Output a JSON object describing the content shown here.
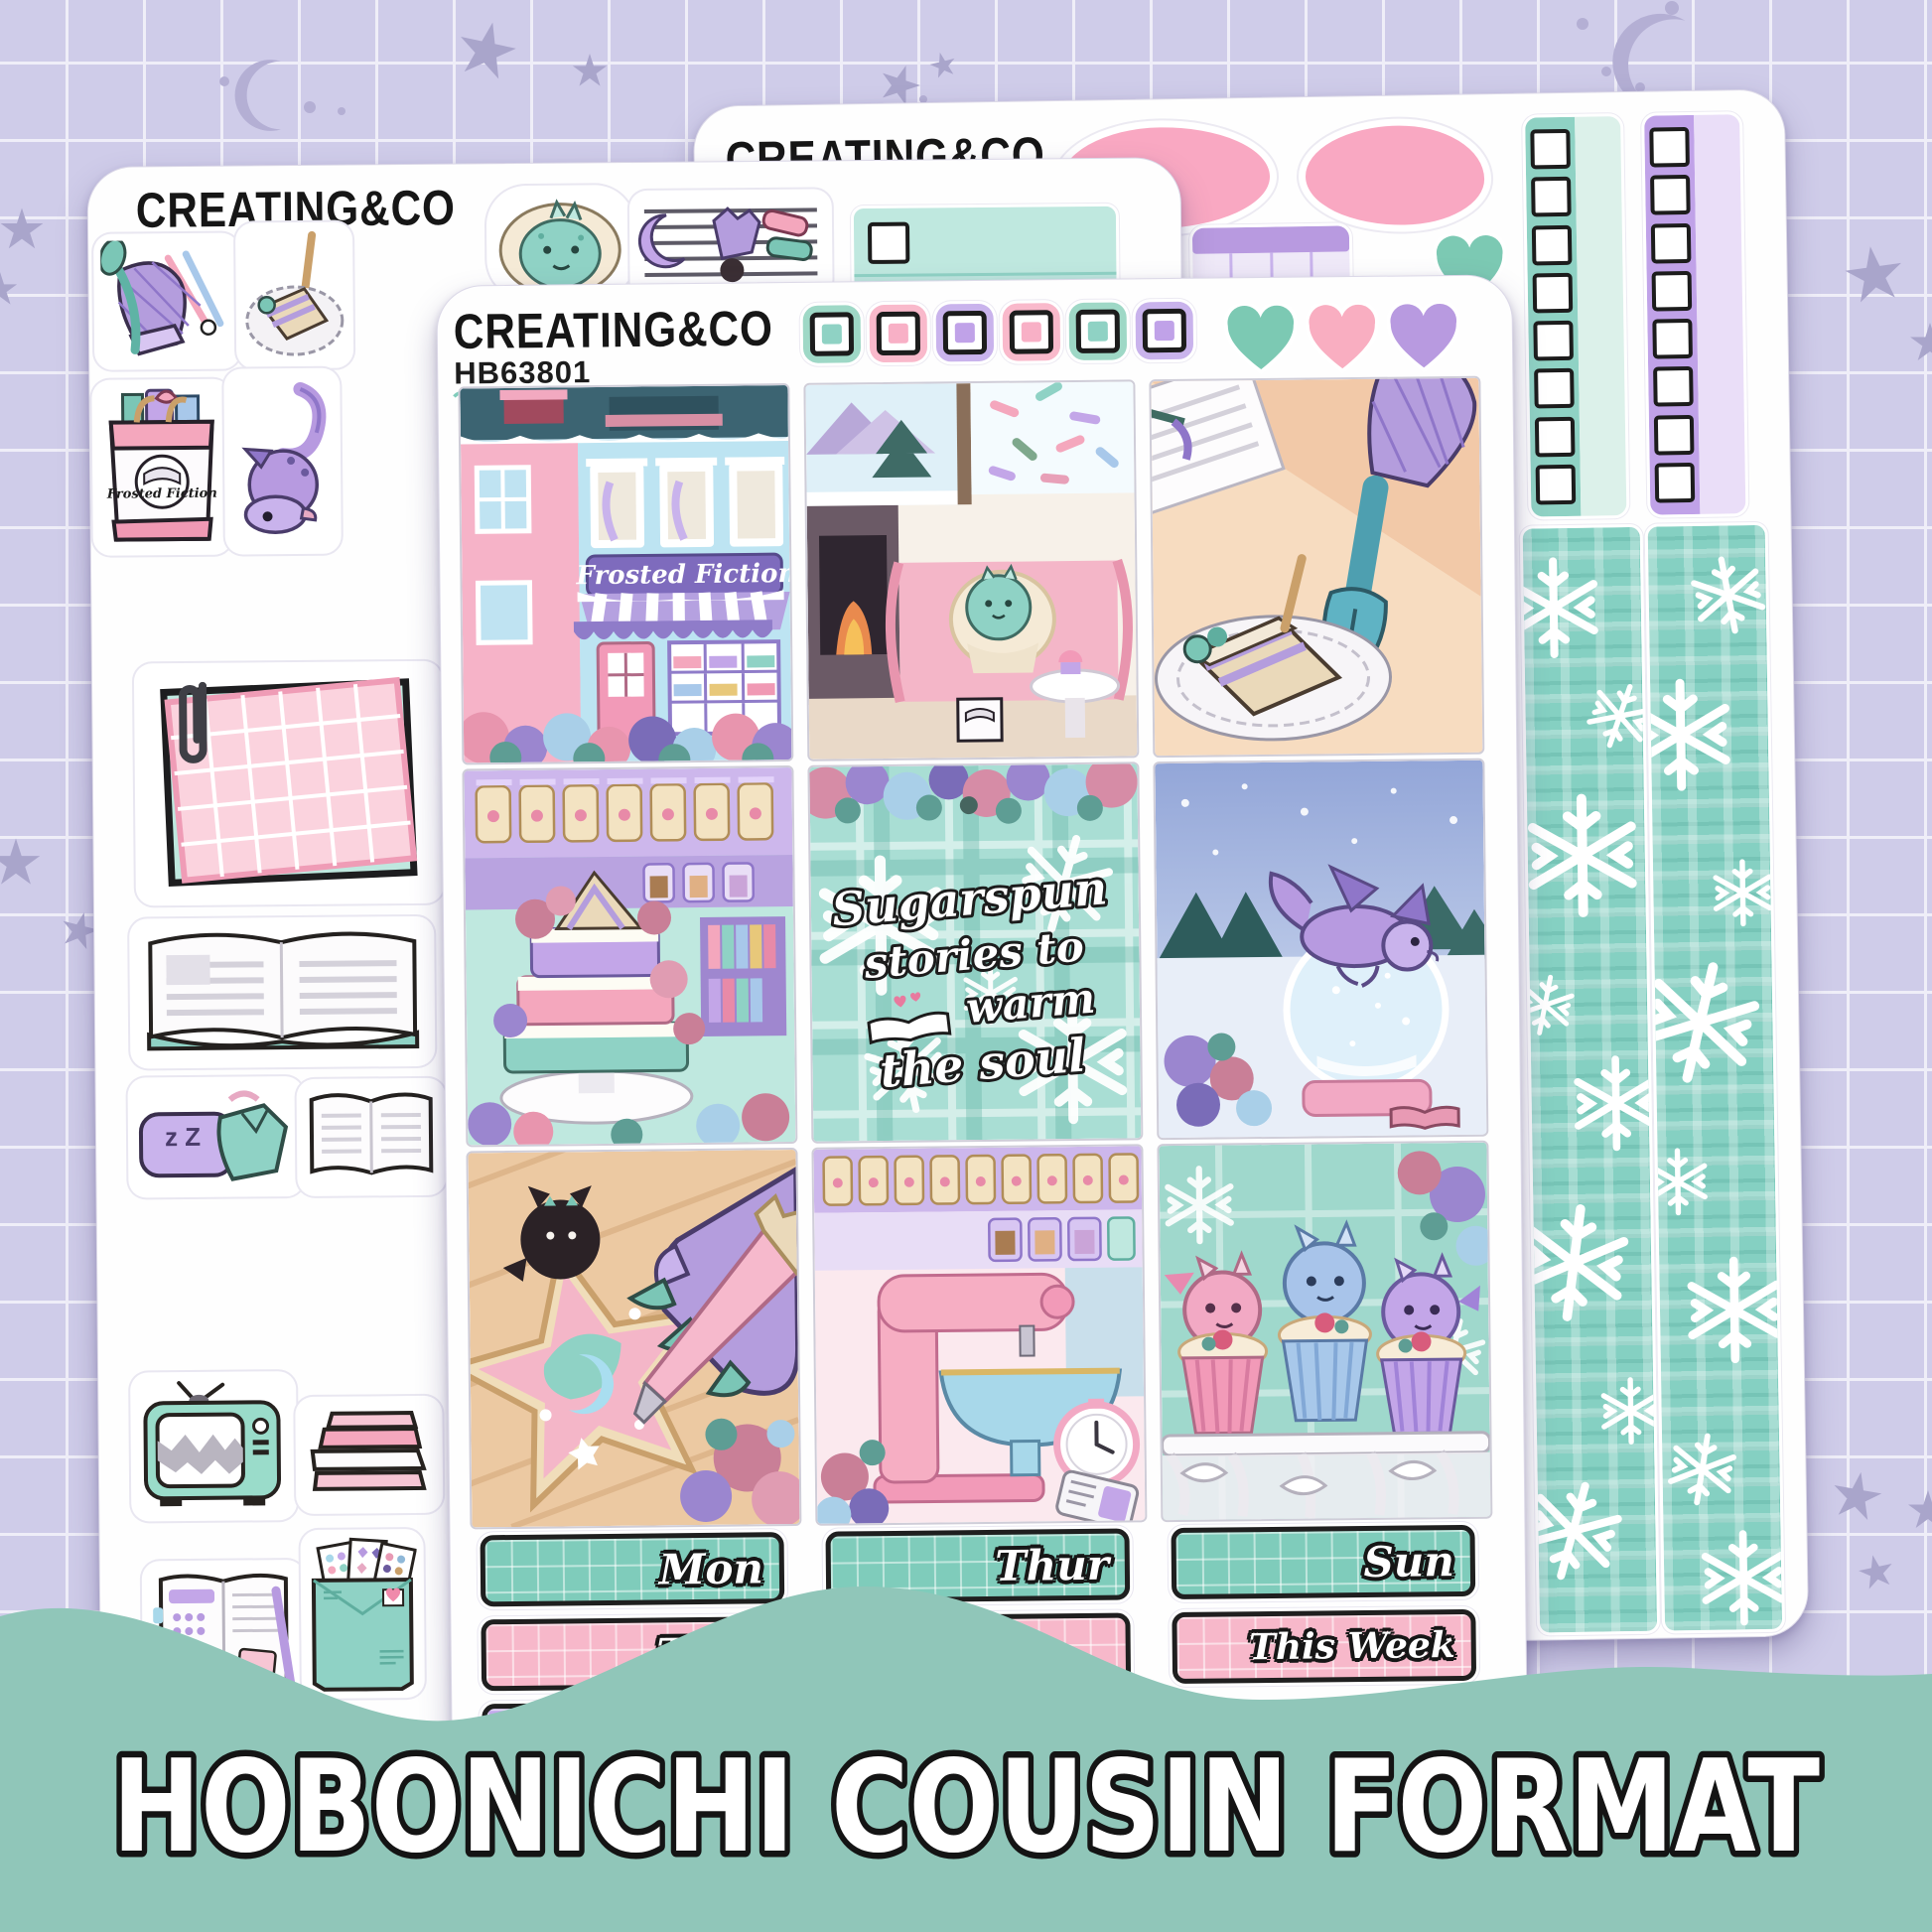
{
  "banner": {
    "text": "HOBONICHI COUSIN FORMAT",
    "color": "#90c6b9"
  },
  "brand": "CREATING&CO",
  "sheets": {
    "front": {
      "code": "HB63801"
    },
    "middle": {
      "code": "HB63802"
    },
    "back": {
      "note": "header and code mostly hidden behind other sheets"
    }
  },
  "header_stickers": {
    "checkbox_colors": [
      "teal",
      "pink",
      "purple",
      "pink",
      "teal",
      "purple"
    ],
    "heart_colors": [
      "teal",
      "pink",
      "purple"
    ]
  },
  "full_boxes": [
    "frosted-fiction-storefront",
    "dragon-reading-by-fireplace",
    "cake-slice-and-oven-mitt",
    "cake-of-books",
    "sugarspun-quote",
    "dragon-on-snow-globe",
    "cookie-decorating-claw",
    "pink-stand-mixer",
    "dragon-cupcakes"
  ],
  "storefront": {
    "sign": "Frosted Fiction"
  },
  "book_bag": {
    "label": "Frosted Fiction"
  },
  "quote_box": {
    "line1": "Sugarspun",
    "line2": "stories to",
    "line3": "warm",
    "line4": "the soul"
  },
  "pillow": {
    "text": "z Z"
  },
  "date_strips": {
    "col1": [
      {
        "label": "Mon",
        "color": "teal"
      },
      {
        "label": "Tues",
        "color": "pink"
      },
      {
        "label": "",
        "color": "purple"
      }
    ],
    "col2": [
      {
        "label": "Thur",
        "color": "teal"
      },
      {
        "label": "",
        "color": "pink"
      }
    ],
    "col3": [
      {
        "label": "Sun",
        "color": "teal"
      },
      {
        "label": "This Week",
        "color": "pink"
      }
    ]
  },
  "middle_sheet_stickers": [
    "oven-mitts-utensils",
    "cake-plate",
    "dragon-in-blanket",
    "cooling-rack-cookies",
    "book-tote-bag",
    "purple-dragon",
    "paperclip-grid-note",
    "open-book",
    "pillow-pajamas",
    "open-book-small",
    "retro-tv",
    "book-stack",
    "open-planner",
    "sticker-mail-envelope"
  ],
  "back_sheet_stickers": [
    "pink-washi-swatch-1",
    "pink-washi-swatch-2",
    "purple-week-strip",
    "teal-heart",
    "teal-checkbox-column",
    "purple-checkbox-column",
    "snowflake-plaid-washi-1",
    "snowflake-plaid-washi-2"
  ],
  "colors": {
    "background": "#cfcce9",
    "grid_line": "#efeef8",
    "stars": "#a9a5cb",
    "teal": "#8fd2c4",
    "pink": "#f8b0c6",
    "purple": "#c0a2e8",
    "banner": "#90c6b9",
    "outline": "#161616"
  }
}
